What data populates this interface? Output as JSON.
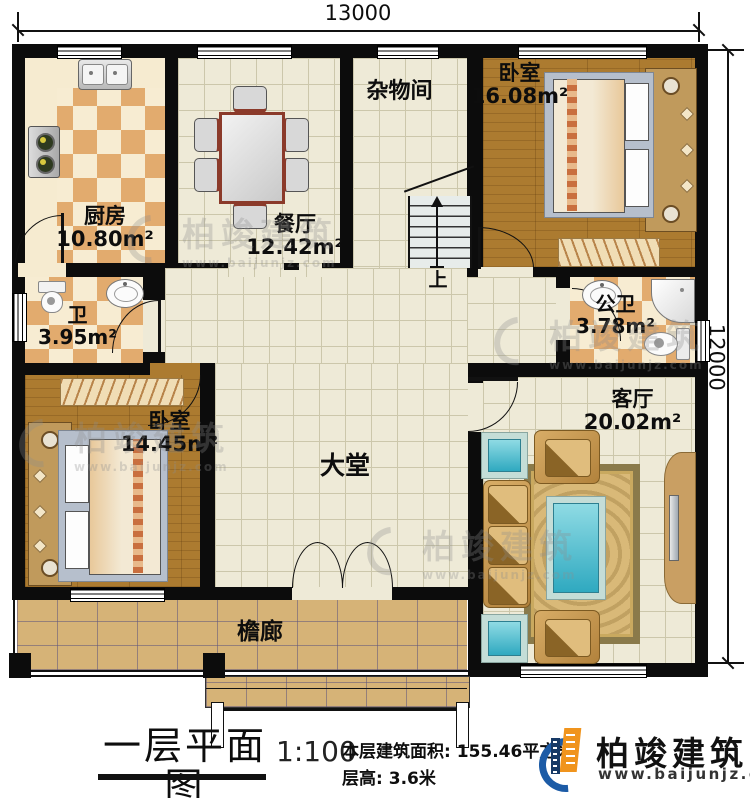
{
  "meta": {
    "title_text": "一层平面图",
    "scale": "1:100",
    "area_label": "本层建筑面积:",
    "area_value": "155.46平方米",
    "height_label": "层高:",
    "height_value": "3.6米"
  },
  "brand": {
    "name": "柏竣建筑",
    "website": "www.baijunjz.com",
    "blue": "#1c5ba6",
    "orange": "#f0941d"
  },
  "watermark": {
    "name": "柏竣建筑",
    "website": "www.baijunjz.com"
  },
  "dimensions": {
    "top": "13000",
    "right": "12000"
  },
  "rooms": {
    "kitchen": {
      "name": "厨房",
      "area": "10.80m²"
    },
    "dining": {
      "name": "餐厅",
      "area": "12.42m²"
    },
    "storage": {
      "name": "杂物间"
    },
    "bedroom_top": {
      "name": "卧室",
      "area": "16.08m²"
    },
    "bath": {
      "name": "卫",
      "area": "3.95m²"
    },
    "public_bath": {
      "name": "公卫",
      "area": "3.78m²"
    },
    "bedroom_left": {
      "name": "卧室",
      "area": "14.45m²"
    },
    "hall": {
      "name": "大堂"
    },
    "living": {
      "name": "客厅",
      "area": "20.02m²"
    },
    "porch": {
      "name": "檐廊"
    }
  },
  "stairs": {
    "up_label": "上"
  }
}
